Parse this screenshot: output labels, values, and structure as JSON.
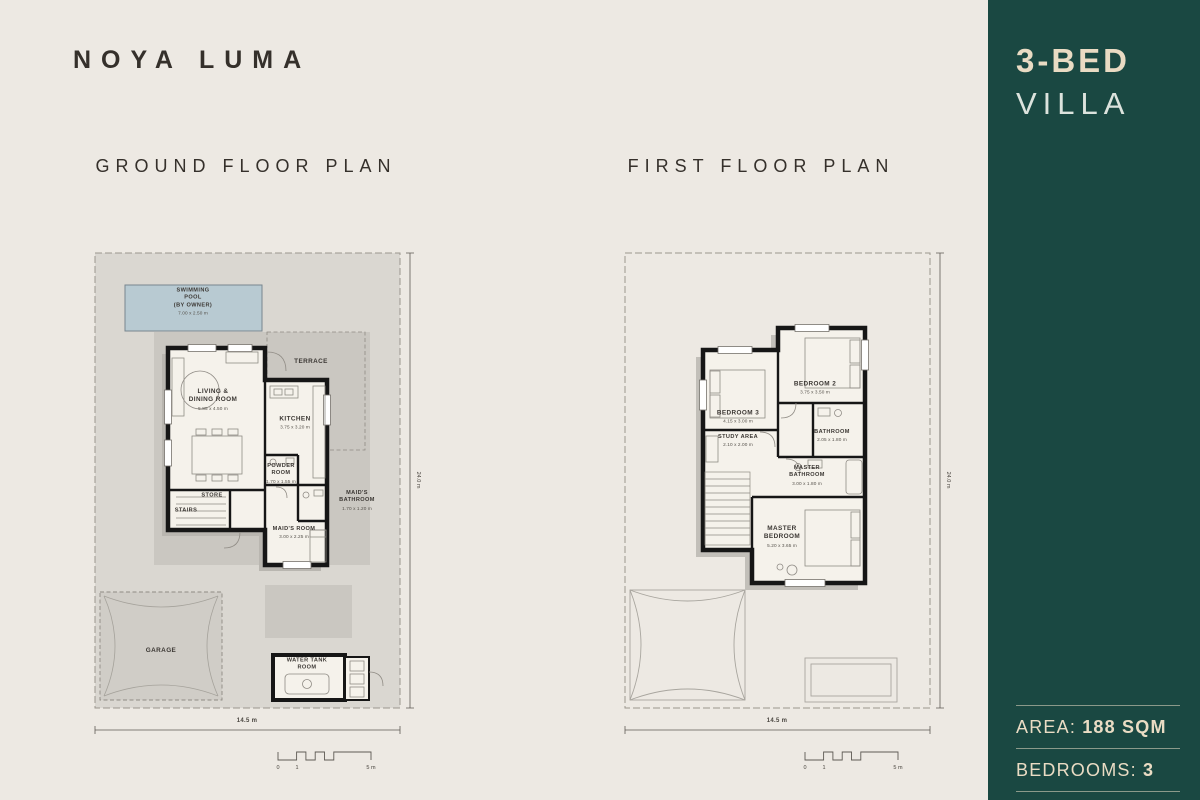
{
  "page": {
    "title": "NOYA LUMA",
    "background": "#EDE9E3"
  },
  "sidebar": {
    "color": "#1A4842",
    "unit_type": "3-BED",
    "unit_kind": "VILLA",
    "stats": [
      {
        "label": "AREA: ",
        "value": "188 SQM"
      },
      {
        "label": "BEDROOMS: ",
        "value": "3"
      }
    ]
  },
  "colors": {
    "background": "#EDE9E3",
    "plot_gray": "#DAD7D1",
    "terrace_gray": "#CAC7C1",
    "pool_blue": "#B8CAD2",
    "wall_black": "#161616",
    "teal": "#1A4842",
    "cream_text": "#E9DBC3"
  },
  "plans": [
    {
      "title": "GROUND FLOOR PLAN",
      "width_dim": "14.5 m",
      "height_dim": "24.0 m",
      "scale_labels": [
        "0",
        "1",
        "5 m"
      ],
      "labels": [
        {
          "text": "SWIMMING\nPOOL\n(BY OWNER)",
          "sub": "7.00 x 2.50 m",
          "x": 113,
          "y": 62,
          "cls": "small"
        },
        {
          "text": "TERRACE",
          "x": 231,
          "y": 122,
          "cls": ""
        },
        {
          "text": "LIVING &\nDINING ROOM",
          "sub": "5.85 x 4.50 m",
          "x": 133,
          "y": 160,
          "cls": ""
        },
        {
          "text": "KITCHEN",
          "sub": "3.75 x 3.20 m",
          "x": 215,
          "y": 183,
          "cls": ""
        },
        {
          "text": "POWDER\nROOM",
          "sub": "1.70 x 1.55 m",
          "x": 201,
          "y": 234,
          "cls": "small"
        },
        {
          "text": "STORE",
          "x": 132,
          "y": 256,
          "cls": "small"
        },
        {
          "text": "STAIRS",
          "x": 106,
          "y": 271,
          "cls": "small"
        },
        {
          "text": "MAID'S\nBATHROOM",
          "sub": "1.70 x 1.20 m",
          "x": 277,
          "y": 261,
          "cls": "small"
        },
        {
          "text": "MAID'S ROOM",
          "sub": "3.00 x 2.25 m",
          "x": 214,
          "y": 293,
          "cls": "small"
        },
        {
          "text": "GARAGE",
          "x": 81,
          "y": 411,
          "cls": ""
        },
        {
          "text": "WATER TANK\nROOM",
          "x": 227,
          "y": 425,
          "cls": "small"
        }
      ]
    },
    {
      "title": "FIRST FLOOR PLAN",
      "width_dim": "14.5 m",
      "height_dim": "24.0 m",
      "scale_labels": [
        "0",
        "1",
        "5 m"
      ],
      "labels": [
        {
          "text": "BEDROOM 2",
          "sub": "3.75 x 3.50 m",
          "x": 205,
          "y": 148,
          "cls": ""
        },
        {
          "text": "BEDROOM 3",
          "sub": "4.15 x 3.00 m",
          "x": 128,
          "y": 177,
          "cls": ""
        },
        {
          "text": "STUDY AREA",
          "sub": "2.10 x 2.00 m",
          "x": 128,
          "y": 201,
          "cls": "small"
        },
        {
          "text": "BATHROOM",
          "sub": "2.05 x 1.80 m",
          "x": 222,
          "y": 196,
          "cls": "small"
        },
        {
          "text": "MASTER\nBATHROOM",
          "sub": "3.00 x 1.80 m",
          "x": 197,
          "y": 236,
          "cls": "small"
        },
        {
          "text": "MASTER\nBEDROOM",
          "sub": "5.20 x 3.65 m",
          "x": 172,
          "y": 297,
          "cls": ""
        }
      ]
    }
  ]
}
